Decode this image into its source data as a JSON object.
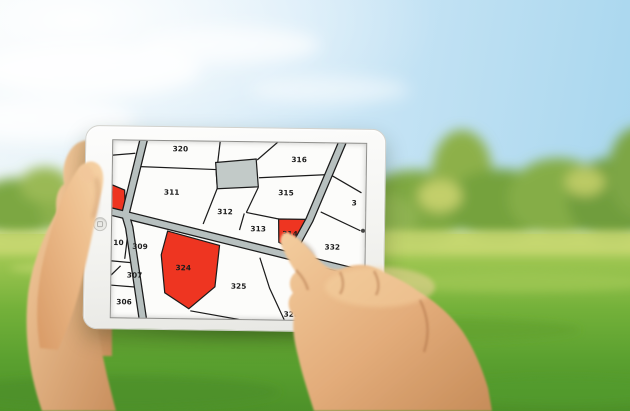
{
  "scene_colors": {
    "sky_blue": "#a7d6ee",
    "tree_green": "#7fa943",
    "grass_green": "#6cab34",
    "skin_tone": "#e6ae7f",
    "tablet_body": "#f6f6f4"
  },
  "map": {
    "background_color": "#fcfcfa",
    "parcel_line_color": "#1b1b1b",
    "road_fill_color": "#b7c0bf",
    "road_casing_color": "#1b1b1b",
    "highlight_color": "#ee3521",
    "gray_parcel_color": "#c2cac8",
    "parcels": [
      {
        "label": "320",
        "highlighted": false
      },
      {
        "label": "311",
        "highlighted": false
      },
      {
        "label": "312",
        "highlighted": false
      },
      {
        "label": "313",
        "highlighted": false
      },
      {
        "label": "314",
        "highlighted": true
      },
      {
        "label": "315",
        "highlighted": false
      },
      {
        "label": "316",
        "highlighted": false
      },
      {
        "label": "332",
        "highlighted": false
      },
      {
        "label": "3",
        "highlighted": false,
        "partial": true
      },
      {
        "label": "10",
        "highlighted": false,
        "partial": true
      },
      {
        "label": "309",
        "highlighted": false
      },
      {
        "label": "307",
        "highlighted": false
      },
      {
        "label": "306",
        "highlighted": false
      },
      {
        "label": "324",
        "highlighted": true
      },
      {
        "label": "325",
        "highlighted": false
      },
      {
        "label": "328",
        "highlighted": false
      }
    ],
    "unlabeled_parcels": [
      {
        "type": "gray-parcel"
      },
      {
        "type": "red-parcel-left-edge",
        "highlighted": true
      }
    ]
  }
}
